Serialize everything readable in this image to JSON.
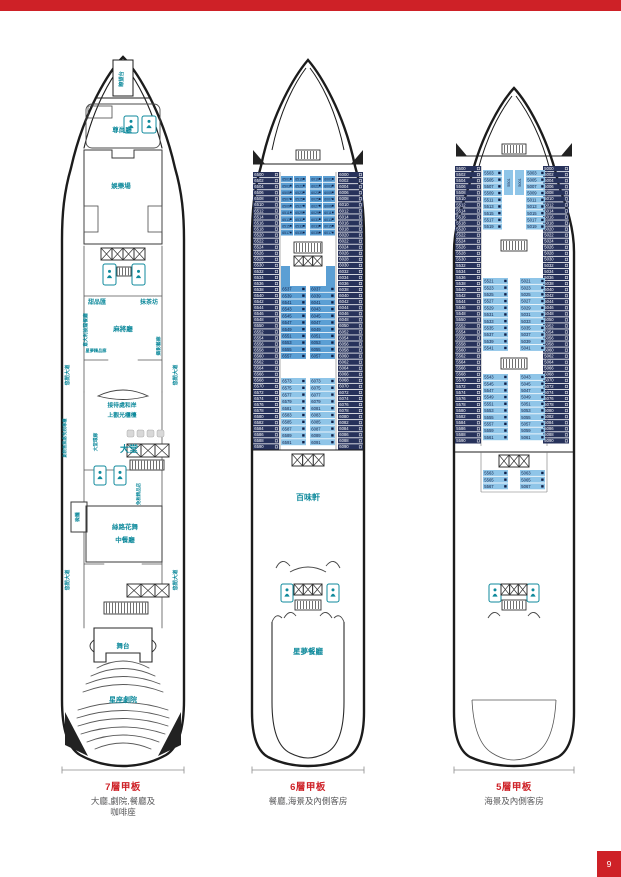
{
  "page": {
    "page_number": "9"
  },
  "colors": {
    "red": "#CE2127",
    "teal": "#0F8A9C",
    "navy": "#27325B",
    "medblue": "#5B9FD4",
    "lightblue": "#8FC5E8",
    "gray_text": "#58585A"
  },
  "captions": [
    {
      "title": "7層甲板",
      "desc1": "大廳,劇院,餐廳及",
      "desc2": "咖啡座"
    },
    {
      "title": "6層甲板",
      "desc1": "餐廳,海景及內側客房",
      "desc2": ""
    },
    {
      "title": "5層甲板",
      "desc1": "海景及內側客房",
      "desc2": ""
    }
  ],
  "ships": {
    "deck7": {
      "labels": {
        "lookout": "瞭望台",
        "vip": "尊尚廳",
        "casino": "娛樂場",
        "sweets": "甜品匯",
        "tea": "抹茶坊",
        "mahjong": "麻將廳",
        "italian": "意大利披薩餐廳",
        "boutique_row": "星夢精品廊",
        "gallery": "攝影藝廊",
        "prom1": "悠閒大道",
        "prom2": "悠閒大道",
        "prom3": "悠閒大道",
        "prom4": "悠閒大道",
        "reception1": "接待處和岸",
        "reception2": "上觀光櫃檯",
        "atrium": "大堂",
        "boxoffice": "劇院售票處/免稅專櫃",
        "atrium_gallery": "大堂環廊",
        "dutyfree": "免稅精品店",
        "bar": "微醺",
        "silkroad1": "絲路花舞",
        "silkroad2": "中餐廳",
        "stage": "舞台",
        "theatre": "星座劇院"
      }
    },
    "deck6": {
      "venues": {
        "lido": "百味軒",
        "dining": "星夢餐廳"
      },
      "outer_port": [
        "6500",
        "6502",
        "6504",
        "6506",
        "6508",
        "6510",
        "6512",
        "6514",
        "6516",
        "6518",
        "6520",
        "6522",
        "6524",
        "6526",
        "6528",
        "6530",
        "6532",
        "6534",
        "6536",
        "6538",
        "6540",
        "6542",
        "6544",
        "6546",
        "6548",
        "6550",
        "6552",
        "6554",
        "6556",
        "6558",
        "6560",
        "6562",
        "6564",
        "6566",
        "6568",
        "6570",
        "6572",
        "6574",
        "6576",
        "6578",
        "6580",
        "6582",
        "6584",
        "6586",
        "6588",
        "6590"
      ],
      "outer_stbd": [
        "6000",
        "6002",
        "6004",
        "6006",
        "6008",
        "6010",
        "6012",
        "6014",
        "6016",
        "6018",
        "6020",
        "6022",
        "6024",
        "6026",
        "6028",
        "6030",
        "6032",
        "6034",
        "6036",
        "6038",
        "6040",
        "6042",
        "6044",
        "6046",
        "6048",
        "6050",
        "6052",
        "6054",
        "6056",
        "6058",
        "6060",
        "6062",
        "6064",
        "6066",
        "6068",
        "6070",
        "6072",
        "6074",
        "6076",
        "6078",
        "6080",
        "6082",
        "6084",
        "6086",
        "6088",
        "6090"
      ],
      "b1a": [
        "6501",
        "6503",
        "6505",
        "6507",
        "6509",
        "6511",
        "6513",
        "6515",
        "6517"
      ],
      "b1b": [
        "6519",
        "6521",
        "6523",
        "6525",
        "6527",
        "6529",
        "6531",
        "6533",
        "6535"
      ],
      "b1c": [
        "6019",
        "6021",
        "6023",
        "6025",
        "6027",
        "6029",
        "6031",
        "6033",
        "6035"
      ],
      "b1d": [
        "6001",
        "6003",
        "6005",
        "6007",
        "6009",
        "6011",
        "6013",
        "6015",
        "6017"
      ],
      "b2_port": [
        "6537",
        "6539",
        "6541",
        "6543",
        "6545",
        "6547",
        "6549",
        "6551",
        "6553",
        "6555",
        "6557"
      ],
      "b2_stbd": [
        "6037",
        "6039",
        "6041",
        "6043",
        "6045",
        "6047",
        "6049",
        "6051",
        "6053",
        "6055",
        "6057"
      ],
      "b3_port": [
        "6573",
        "6575",
        "6577",
        "6579",
        "6581",
        "6583",
        "6585",
        "6587",
        "6589",
        "6591"
      ],
      "b3_stbd": [
        "6073",
        "6075",
        "6077",
        "6079",
        "6081",
        "6083",
        "6085",
        "6087",
        "6089",
        "6091"
      ]
    },
    "deck5": {
      "outer_port": [
        "5500",
        "5502",
        "5504",
        "5506",
        "5508",
        "5510",
        "5512",
        "5514",
        "5516",
        "5518",
        "5520",
        "5522",
        "5524",
        "5526",
        "5528",
        "5530",
        "5532",
        "5534",
        "5536",
        "5538",
        "5540",
        "5542",
        "5544",
        "5546",
        "5548",
        "5550",
        "5552",
        "5554",
        "5556",
        "5558",
        "5560",
        "5562",
        "5564",
        "5566",
        "5568",
        "5570",
        "5572",
        "5574",
        "5576",
        "5578",
        "5580",
        "5582",
        "5584",
        "5586",
        "5588",
        "5590"
      ],
      "outer_stbd": [
        "5000",
        "5002",
        "5004",
        "5006",
        "5008",
        "5010",
        "5012",
        "5014",
        "5016",
        "5018",
        "5020",
        "5022",
        "5024",
        "5026",
        "5028",
        "5030",
        "5032",
        "5034",
        "5036",
        "5038",
        "5040",
        "5042",
        "5044",
        "5046",
        "5048",
        "5050",
        "5052",
        "5054",
        "5056",
        "5058",
        "5060",
        "5062",
        "5064",
        "5066",
        "5068",
        "5070",
        "5072",
        "5074",
        "5076",
        "5078",
        "5080",
        "5082",
        "5084",
        "5086",
        "5088",
        "5090"
      ],
      "b1_port": [
        "5503",
        "5505",
        "5507",
        "5509",
        "5511",
        "5513",
        "5515",
        "5517",
        "5519"
      ],
      "b1_stbd": [
        "5003",
        "5005",
        "5007",
        "5009",
        "5011",
        "5013",
        "5015",
        "5017",
        "5019"
      ],
      "center_v": [
        "5501",
        "5001"
      ],
      "b2_port": [
        "5521",
        "5523",
        "5525",
        "5527",
        "5529",
        "5531",
        "5533",
        "5535",
        "5537",
        "5539",
        "5541"
      ],
      "b2_stbd": [
        "5021",
        "5023",
        "5025",
        "5027",
        "5029",
        "5031",
        "5033",
        "5035",
        "5037",
        "5039",
        "5041"
      ],
      "b3_port": [
        "5543",
        "5545",
        "5547",
        "5549",
        "5551",
        "5553",
        "5555",
        "5557",
        "5559",
        "5561"
      ],
      "b3_stbd": [
        "5043",
        "5045",
        "5047",
        "5049",
        "5051",
        "5053",
        "5055",
        "5057",
        "5059",
        "5061"
      ],
      "b4_port": [
        "5563",
        "5565",
        "5567"
      ],
      "b4_stbd": [
        "5063",
        "5065",
        "5067"
      ]
    }
  }
}
